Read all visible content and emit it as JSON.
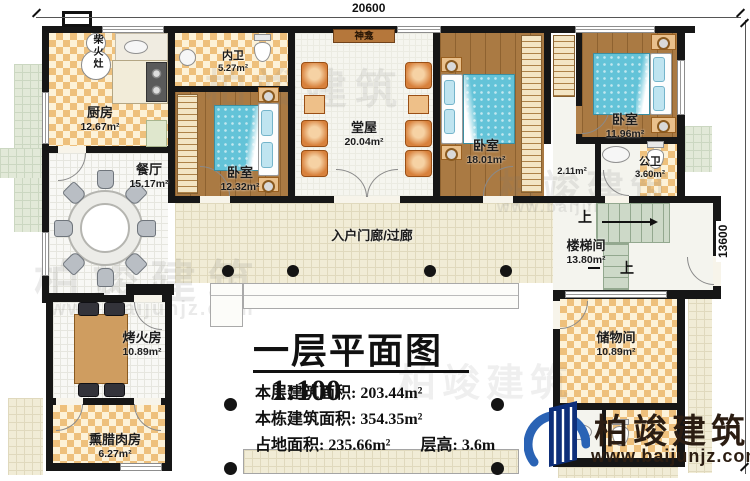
{
  "dimensions": {
    "top": "20600",
    "right": "13600"
  },
  "watermark": {
    "brand": "柏竣建筑",
    "url": "www.baijunjz.com"
  },
  "logo": {
    "brand": "柏竣建筑",
    "url": "www.baijunjz.com"
  },
  "rooms": {
    "kitchen": {
      "name": "厨房",
      "area": "12.67m²"
    },
    "wood_stove": {
      "name": "柴火灶"
    },
    "inner_bath": {
      "name": "内卫",
      "area": "5.27m²"
    },
    "shrine": {
      "name": "神龛"
    },
    "hall": {
      "name": "堂屋",
      "area": "20.04m²"
    },
    "bedroom_left": {
      "name": "卧室",
      "area": "12.32m²"
    },
    "bedroom_mid": {
      "name": "卧室",
      "area": "18.01m²"
    },
    "bedroom_right": {
      "name": "卧室",
      "area": "11.96m²"
    },
    "public_bath": {
      "name": "公卫",
      "area": "3.60m²"
    },
    "vestibule": {
      "area": "2.11m²"
    },
    "dining": {
      "name": "餐厅",
      "area": "15.17m²"
    },
    "corridor": {
      "name": "入户门廊/过廊"
    },
    "stairwell": {
      "name": "楼梯间",
      "area": "13.80m²",
      "up": "上"
    },
    "fire_room": {
      "name": "烤火房",
      "area": "10.89m²"
    },
    "bacon_room": {
      "name": "熏腊肉房",
      "area": "6.27m²"
    },
    "storage": {
      "name": "储物间",
      "area": "10.89m²"
    }
  },
  "titleblock": {
    "title": "一层平面图",
    "scale": "1:100",
    "lines": [
      {
        "label": "本层建筑面积:",
        "value": "203.44m²"
      },
      {
        "label": "本栋建筑面积:",
        "value": "354.35m²"
      },
      {
        "label": "占地面积:",
        "value": "235.66m²"
      },
      {
        "label": "层高:",
        "value": "3.6m"
      }
    ]
  }
}
